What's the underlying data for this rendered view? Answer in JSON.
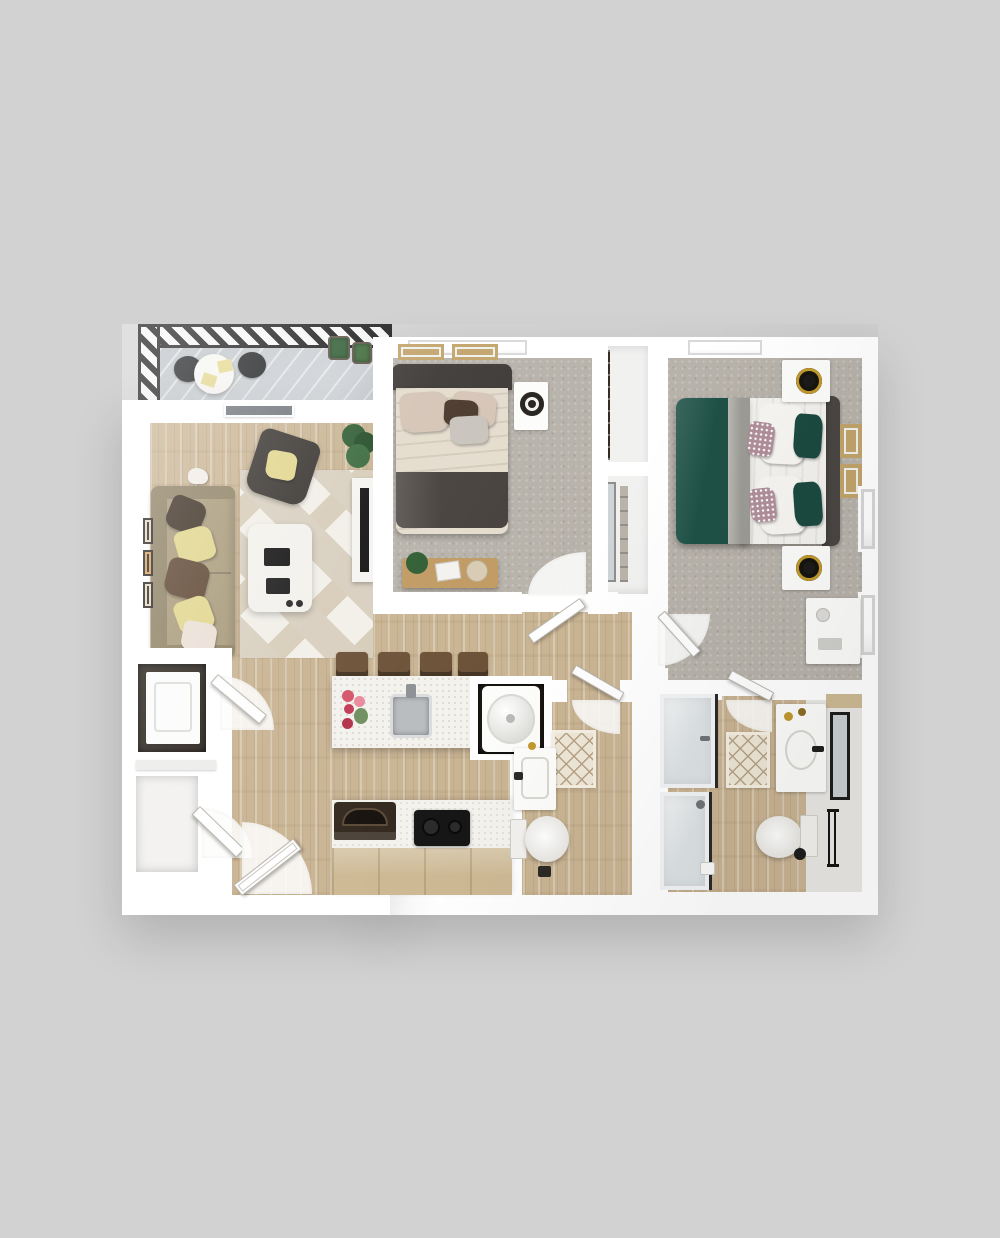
{
  "meta": {
    "description": "3D top-down rendering of a two-bedroom, two-bath apartment floor plan on a gray background",
    "visible_text": []
  },
  "palette": {
    "background": "#d2d2d2",
    "wall": "#ffffff",
    "wood_floor": "#c9b493",
    "carpet": "#b7b2aa",
    "balcony_floor": "#ccd1d6",
    "railing_dark": "#1c1c1c",
    "rug_living_a": "#d8cfbf",
    "rug_living_b": "#f2efe8",
    "rug_diamond_bg": "#eee6d6",
    "rug_diamond_line": "#b5a285",
    "sofa": "#a89a7a",
    "sofa_dark": "#8e8164",
    "pillow_yellow": "#e0d58c",
    "pillow_brown": "#3d2f23",
    "pillow_choc": "#5d4430",
    "pillow_white": "#eadfd6",
    "armchair": "#37332f",
    "bed1_frame": "#3c3835",
    "bed1_linen": "#e4dccd",
    "bed1_pillow": "#d5c4b6",
    "bed1_foot": "#45403c",
    "bed2_green": "#1e5146",
    "bed2_white": "#f3f2ef",
    "bed2_gray": "#9c9b95",
    "bed2_head": "#4a4643",
    "frame_tan": "#c2a36b",
    "plant_green": "#2f5d33",
    "island_counter": "#f4f2ed",
    "steel": "#b9bcbf",
    "counter_wood": "#cdb994",
    "cooktop_black": "#161616",
    "appliance_dark": "#33281e",
    "shower_glass": "#dde2e4",
    "glass_frame": "#2a2a2a",
    "closet_dark": "#322a22",
    "gold": "#c2992f"
  },
  "rooms": [
    {
      "id": "balcony"
    },
    {
      "id": "living-room"
    },
    {
      "id": "bedroom-1"
    },
    {
      "id": "closet-hall"
    },
    {
      "id": "bedroom-2"
    },
    {
      "id": "entry"
    },
    {
      "id": "kitchen"
    },
    {
      "id": "laundry-closet"
    },
    {
      "id": "bathroom-1"
    },
    {
      "id": "hallway"
    },
    {
      "id": "bathroom-2"
    }
  ],
  "furniture_icons": [
    "patio-table-icon",
    "patio-chair-icon",
    "planter-icon",
    "sofa-icon",
    "armchair-icon",
    "coffee-table-icon",
    "tv-console-icon",
    "wall-frame-icon",
    "potted-plant-icon",
    "double-bed-icon",
    "nightstand-icon",
    "lamp-icon",
    "bench-icon",
    "desk-icon",
    "kitchen-island-icon",
    "sink-icon",
    "bar-stool-icon",
    "flower-vase-icon",
    "cooktop-icon",
    "oven-icon",
    "washer-icon",
    "toilet-icon",
    "vanity-sink-icon",
    "mirror-icon",
    "shower-icon",
    "towel-bar-icon",
    "bath-rug-icon",
    "door-icon",
    "window-icon"
  ]
}
